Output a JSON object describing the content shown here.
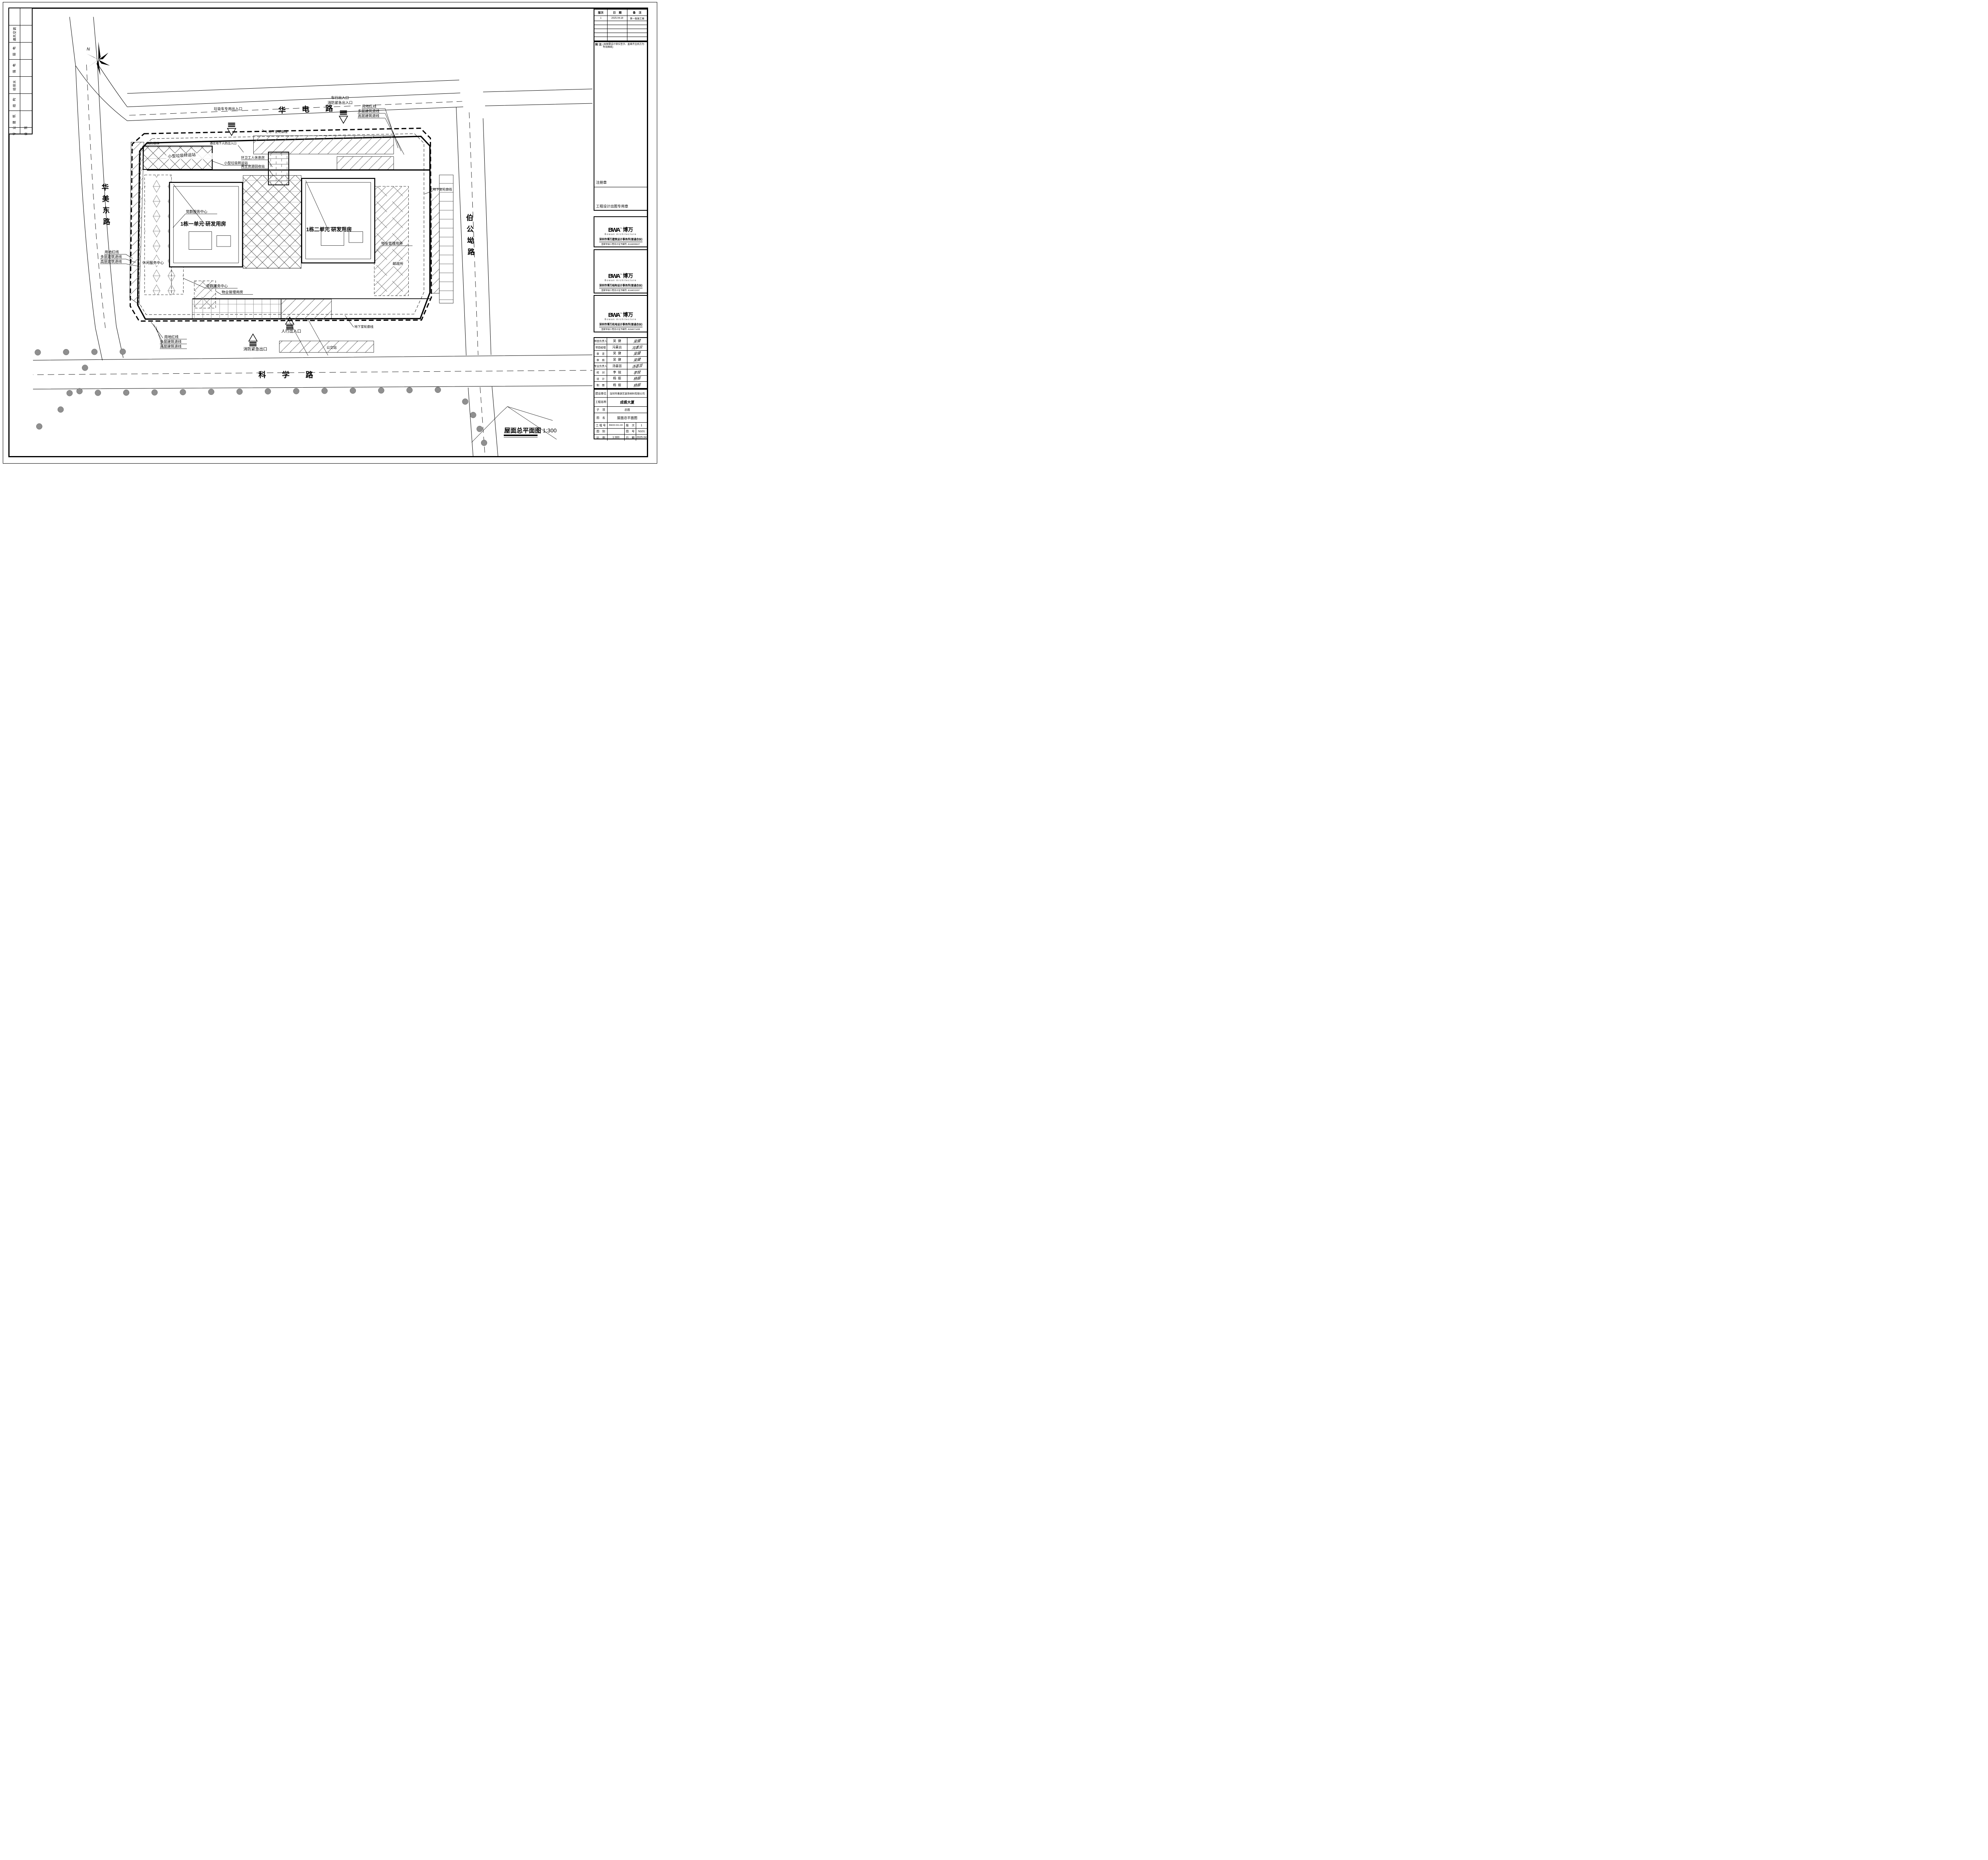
{
  "signoff": {
    "headers": {
      "discipline": "专  业",
      "countersign": "会  签"
    },
    "rows": [
      "通风空调",
      "弱  电",
      "强  电",
      "给排水",
      "结  构",
      "建  筑"
    ]
  },
  "revisions": {
    "headers": {
      "ver": "版次",
      "date": "日    期",
      "note": "备    注"
    },
    "row1": {
      "ver": "1",
      "date": "2025.04.18",
      "note": "第一版施工图"
    }
  },
  "notes": {
    "label": "附 注:",
    "text": "(本图需设计单位签字、盖章齐全后方为有效图纸)"
  },
  "stamps": {
    "registration": "注册章",
    "issue": "工程设计出图专用章"
  },
  "firms": [
    {
      "logo_en": "BWA",
      "logo_tm": "TM",
      "logo_cn": "博万",
      "logo_sub": "Bowan Architecture",
      "name": "深圳市博万建筑设计事务所(普通合伙)",
      "cert": "国家甲级工程设计证书编号: A144006627"
    },
    {
      "logo_en": "BWA",
      "logo_tm": "TM",
      "logo_cn": "博万",
      "logo_sub": "Bowan Architecture",
      "name": "深圳市博万结构设计事务所(普通合伙)",
      "cert": "国家甲级工程设计证书编号: A144011697"
    },
    {
      "logo_en": "BWA",
      "logo_tm": "TM",
      "logo_cn": "博万",
      "logo_sub": "Bowan Architecture",
      "name": "深圳市博万机电设计事务所(普通合伙)",
      "cert": "国家甲级工程设计证书编号: A244071438"
    }
  ],
  "personnel": [
    {
      "role": "项目负责人",
      "name": "吴  健",
      "sign": "吴健"
    },
    {
      "role": "项目经理",
      "name": "冯素云",
      "sign": "冯素云"
    },
    {
      "role": "审    定",
      "name": "吴  健",
      "sign": "吴健"
    },
    {
      "role": "审    核",
      "name": "吴  健",
      "sign": "吴健"
    },
    {
      "role": "专业负责人",
      "name": "汤荟芸",
      "sign": "汤荟芸"
    },
    {
      "role": "校    对",
      "name": "李  锐",
      "sign": "李锐"
    },
    {
      "role": "设    计",
      "name": "杨  振",
      "sign": "杨振"
    },
    {
      "role": "制    图",
      "name": "杨  振",
      "sign": "杨振"
    }
  ],
  "info": {
    "client_label": "建设单位",
    "client": "深圳市惠源艺装饰材料有限公司",
    "project_label": "工程名称",
    "project": "成裘大厦",
    "subitem_label": "子    项",
    "subitem": "总图",
    "drawing_label": "图    名",
    "drawing": "屋面总平面图",
    "jobno_label": "工 程 号",
    "jobno": "BW22-011-03",
    "version_label": "版    次",
    "version": "1",
    "category_label": "图    别",
    "category": "",
    "sheetno_label": "图    号",
    "sheetno": "N101",
    "scale_label": "比    例",
    "scale": "1:300",
    "date_label": "日    期",
    "date": "2025.04"
  },
  "plan": {
    "north": "N",
    "title": "屋面总平面图",
    "title_scale": "1:300",
    "roads": {
      "north": "华 电 路",
      "south": "科 学 路",
      "west_chars": [
        "华",
        "美",
        "东",
        "路"
      ],
      "east_chars": [
        "伯",
        "公",
        "坳",
        "路"
      ]
    },
    "buildings": {
      "u1": "1栋一单元 研发用房",
      "u2": "1栋二单元 研发用房"
    },
    "labels": {
      "red_line": "用地红线",
      "multi_setback": "多层建筑退线",
      "high_setback": "高层建筑退线",
      "veh_entry": "车行出入口",
      "fire_entry": "消防紧急出入口",
      "garbage_entry": "垃圾车专用出入口",
      "ped_entry": "人行出入口",
      "fire_exit": "消防紧急出口",
      "bus": "公交站",
      "basement": "地下室轮廓线",
      "party": "党群服务中心",
      "property": "物业管理用房",
      "post": "邮政所",
      "leisure": "休闲服务中心",
      "garbage_station": "小型垃圾转运站",
      "sanitation": "环卫工人休息房",
      "recycle": "再生资源回收站",
      "fire_stair": "消防楼梯",
      "civil_defense": "通往地下人防出入口"
    }
  }
}
